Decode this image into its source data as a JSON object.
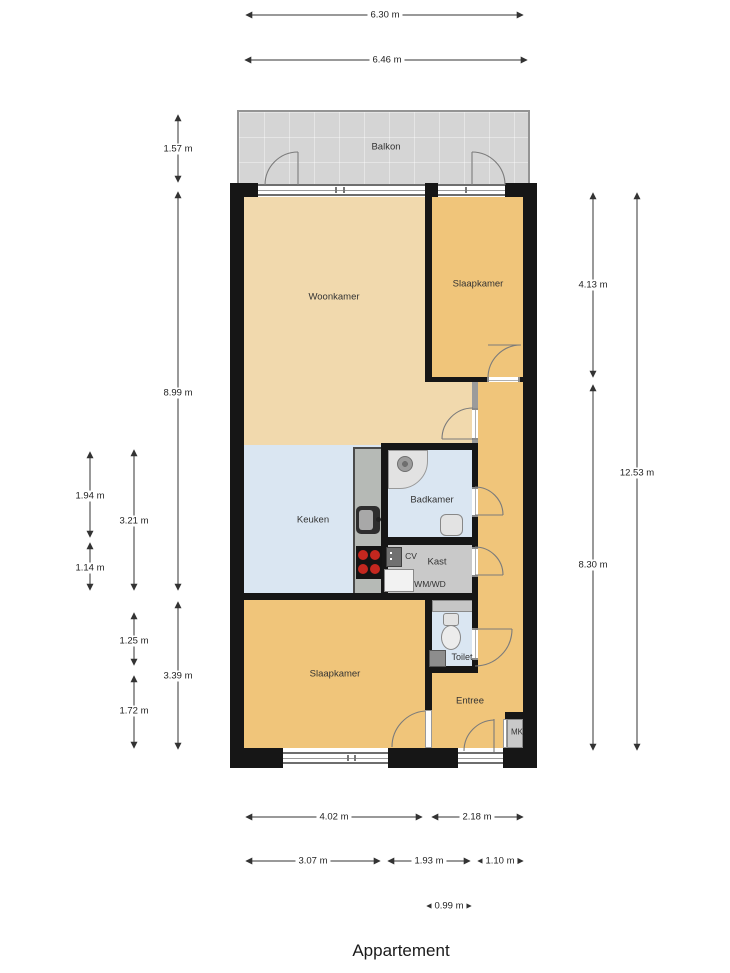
{
  "title": "Appartement",
  "rooms": {
    "balkon": {
      "label": "Balkon"
    },
    "woonkamer": {
      "label": "Woonkamer"
    },
    "slaapkamer_top": {
      "label": "Slaapkamer"
    },
    "keuken": {
      "label": "Keuken"
    },
    "badkamer": {
      "label": "Badkamer"
    },
    "kast": {
      "label": "Kast"
    },
    "cv": {
      "label": "CV"
    },
    "wm_wd": {
      "label": "WM/WD"
    },
    "toilet": {
      "label": "Toilet"
    },
    "slaapkamer_bottom": {
      "label": "Slaapkamer"
    },
    "entree": {
      "label": "Entree"
    },
    "mk": {
      "label": "MK"
    }
  },
  "dimensions": {
    "top": [
      {
        "label": "6.30 m"
      },
      {
        "label": "6.46 m"
      }
    ],
    "left": [
      {
        "label": "1.57 m"
      },
      {
        "label": "8.99 m"
      },
      {
        "label": "3.39 m"
      },
      {
        "label": "3.21 m"
      },
      {
        "label": "1.25 m"
      },
      {
        "label": "1.72 m"
      },
      {
        "label": "1.94 m"
      },
      {
        "label": "1.14 m"
      }
    ],
    "right": [
      {
        "label": "4.13 m"
      },
      {
        "label": "8.30 m"
      },
      {
        "label": "12.53 m"
      }
    ],
    "bottom": [
      {
        "label": "4.02 m"
      },
      {
        "label": "2.18 m"
      },
      {
        "label": "3.07 m"
      },
      {
        "label": "1.93 m"
      },
      {
        "label": "1.10 m"
      },
      {
        "label": "0.99 m"
      }
    ]
  },
  "colors": {
    "wall": "#161616",
    "tan": "#f1d9ad",
    "orange": "#f0c57a",
    "wet": "#dae6f2",
    "gray": "#c9c9c9",
    "balcony": "#d5d5d5",
    "burner": "#c4271f"
  }
}
